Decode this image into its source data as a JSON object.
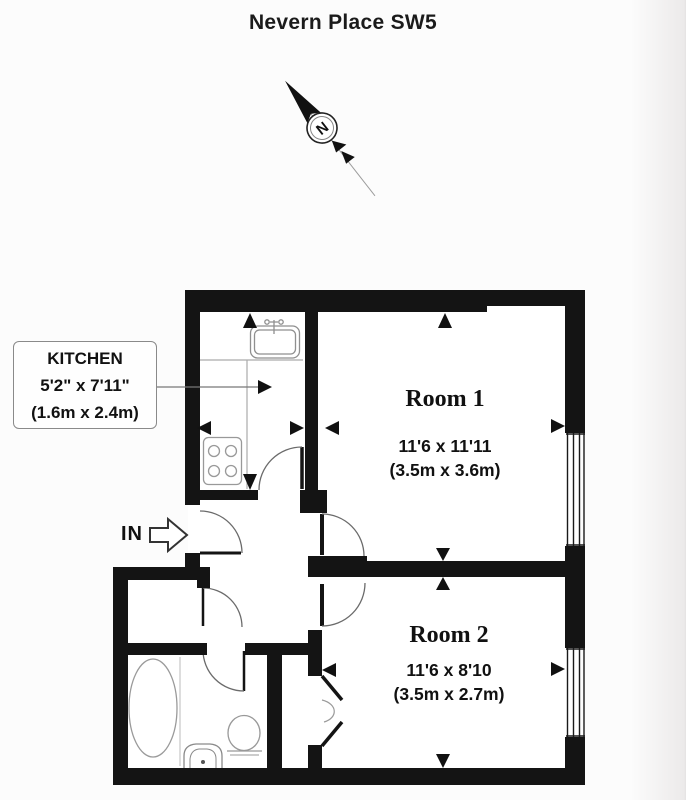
{
  "title": "Nevern Place SW5",
  "compass": {
    "north_label": "N"
  },
  "entrance": {
    "label": "IN"
  },
  "kitchen": {
    "name": "KITCHEN",
    "size_imperial": "5'2\" x 7'11\"",
    "size_metric": "(1.6m x 2.4m)"
  },
  "rooms": [
    {
      "name": "Room 1",
      "size_imperial": "11'6 x 11'11",
      "size_metric": "(3.5m x 3.6m)"
    },
    {
      "name": "Room 2",
      "size_imperial": "11'6 x 8'10",
      "size_metric": "(3.5m x 2.7m)"
    }
  ],
  "colors": {
    "wall": "#141414",
    "arc_line": "#666666",
    "fixture_line": "#999999",
    "page_bg": "#fcfcfc",
    "plan_bg": "#ffffff"
  }
}
